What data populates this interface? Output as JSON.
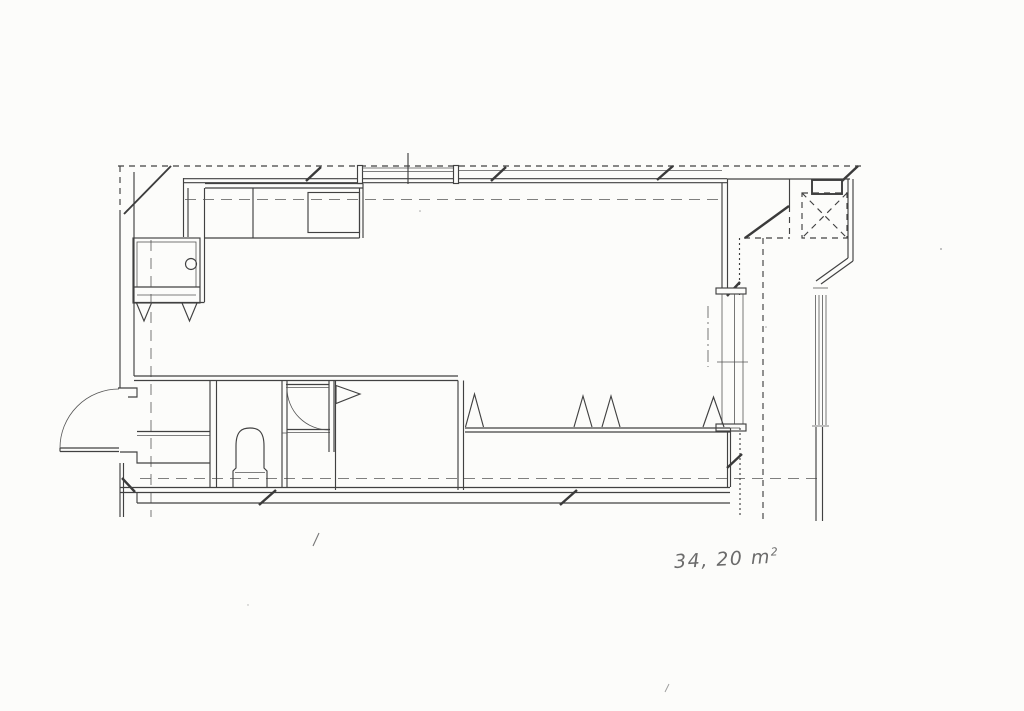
{
  "page": {
    "background": "#fcfcfa",
    "ink": "#414141",
    "ink_light": "#8a8a8a",
    "label_color": "#6b6b6b"
  },
  "annotation": {
    "area_value": "34, 20",
    "area_unit": "m",
    "area_exponent": "2"
  },
  "plan_elements": {
    "drawing_type": "floor-plan",
    "symbols": [
      "exterior-wall",
      "top-window-with-center-mullion",
      "glazing-band-with-mullion-slashes",
      "corner-brace-diagonals",
      "kitchen-counter-l-shape",
      "kitchen-sink-square",
      "appliance-cabinet-with-knob",
      "down-arrow-triangles",
      "entry-door-quarter-swing",
      "wc-door-quarter-swing",
      "toilet",
      "pennant-section-marker",
      "closet-partitions",
      "bench-counter-with-triangle-markers",
      "sliding-window-right",
      "balcony-rail-lines",
      "pipe-shaft-x-box",
      "dashed-overhead-lines",
      "module-grid-dashed-lines",
      "break-slash-marks",
      "handwritten-area-label"
    ]
  }
}
